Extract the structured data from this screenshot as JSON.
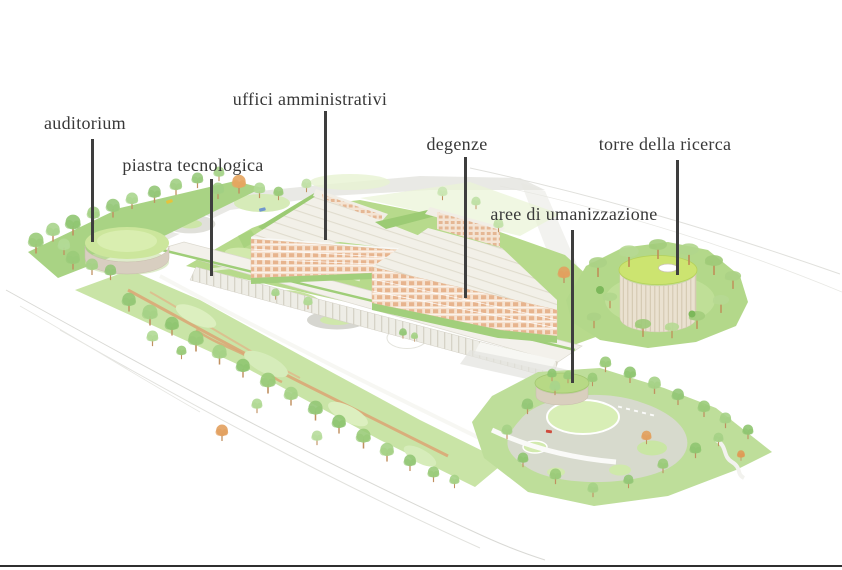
{
  "diagram": {
    "labels": [
      {
        "id": "auditorium",
        "text": "auditorium"
      },
      {
        "id": "piastra-tecnologica",
        "text": "piastra tecnologica"
      },
      {
        "id": "uffici-amministrativi",
        "text": "uffici amministrativi"
      },
      {
        "id": "degenze",
        "text": "degenze"
      },
      {
        "id": "aree-di-umanizzazione",
        "text": "aree di umanizzazione"
      },
      {
        "id": "torre-della-ricerca",
        "text": "torre della ricerca"
      }
    ],
    "colors": {
      "label_text": "#383838",
      "leader_line": "#3e3e3e",
      "lawn_green": "#b7da8c",
      "tree_green": "#9acb79",
      "autumn_orange": "#e2a05e",
      "facade_terracotta": "#e3a97d",
      "roof_cream": "#f2f0e8",
      "road_gray": "#dcdcd6"
    }
  }
}
